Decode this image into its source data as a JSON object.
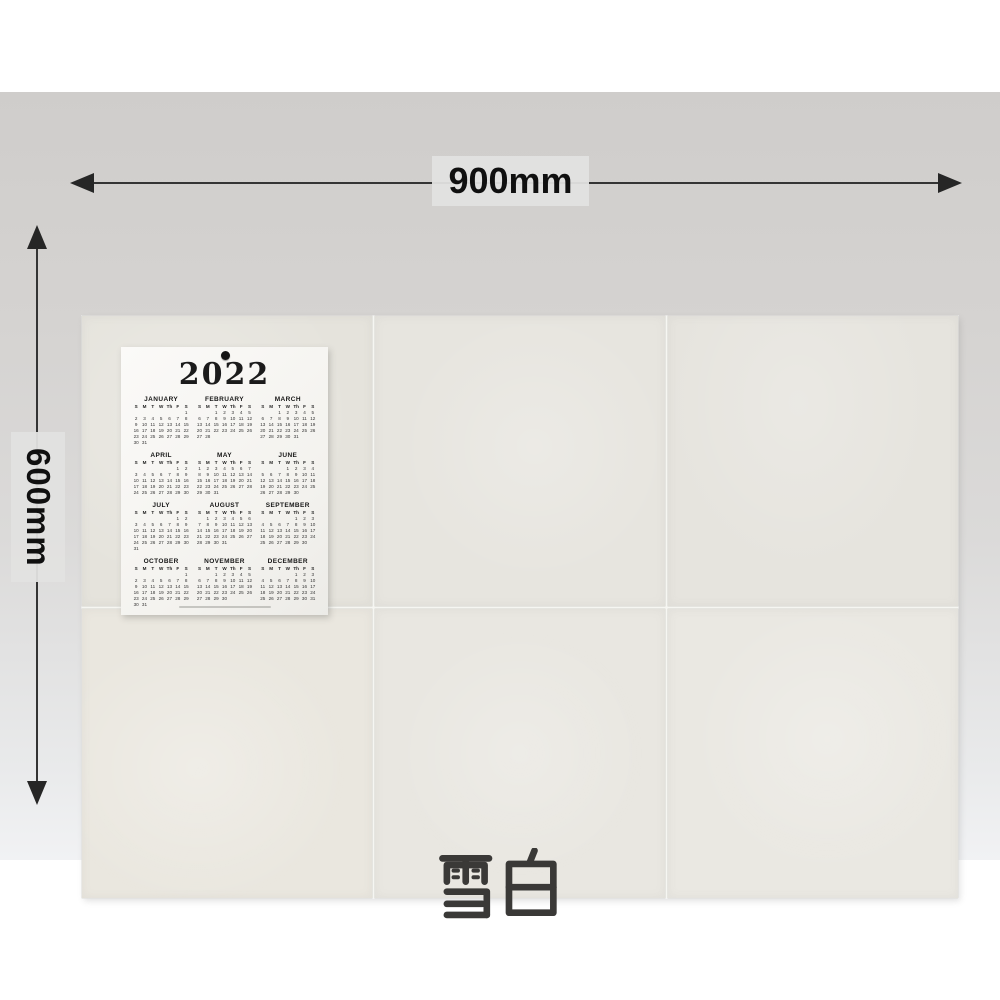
{
  "product": {
    "name_cjk": "雪白",
    "name_meaning": "snow white"
  },
  "dimensions": {
    "width_label": "900mm",
    "height_label": "600mm"
  },
  "board": {
    "tile_cols": 3,
    "tile_rows": 2,
    "tile_color": "#e8e6e0",
    "seam_color": "#f6f6f2"
  },
  "calendar": {
    "year": "2022",
    "day_headers": [
      "S",
      "M",
      "T",
      "W",
      "Th",
      "F",
      "S"
    ],
    "months": [
      {
        "name": "JANUARY",
        "start_dow": 6,
        "days": 31
      },
      {
        "name": "FEBRUARY",
        "start_dow": 2,
        "days": 28
      },
      {
        "name": "MARCH",
        "start_dow": 2,
        "days": 31
      },
      {
        "name": "APRIL",
        "start_dow": 5,
        "days": 30
      },
      {
        "name": "MAY",
        "start_dow": 0,
        "days": 31
      },
      {
        "name": "JUNE",
        "start_dow": 3,
        "days": 30
      },
      {
        "name": "JULY",
        "start_dow": 5,
        "days": 31
      },
      {
        "name": "AUGUST",
        "start_dow": 1,
        "days": 31
      },
      {
        "name": "SEPTEMBER",
        "start_dow": 4,
        "days": 30
      },
      {
        "name": "OCTOBER",
        "start_dow": 6,
        "days": 31
      },
      {
        "name": "NOVEMBER",
        "start_dow": 2,
        "days": 30
      },
      {
        "name": "DECEMBER",
        "start_dow": 4,
        "days": 31
      }
    ]
  },
  "colors": {
    "backdrop_gray": "#d4d2d0",
    "label_box_gray": "#e2e1e0",
    "arrow_black": "#262626",
    "product_text": "#3a3937",
    "calendar_paper": "#f7f6f2"
  }
}
